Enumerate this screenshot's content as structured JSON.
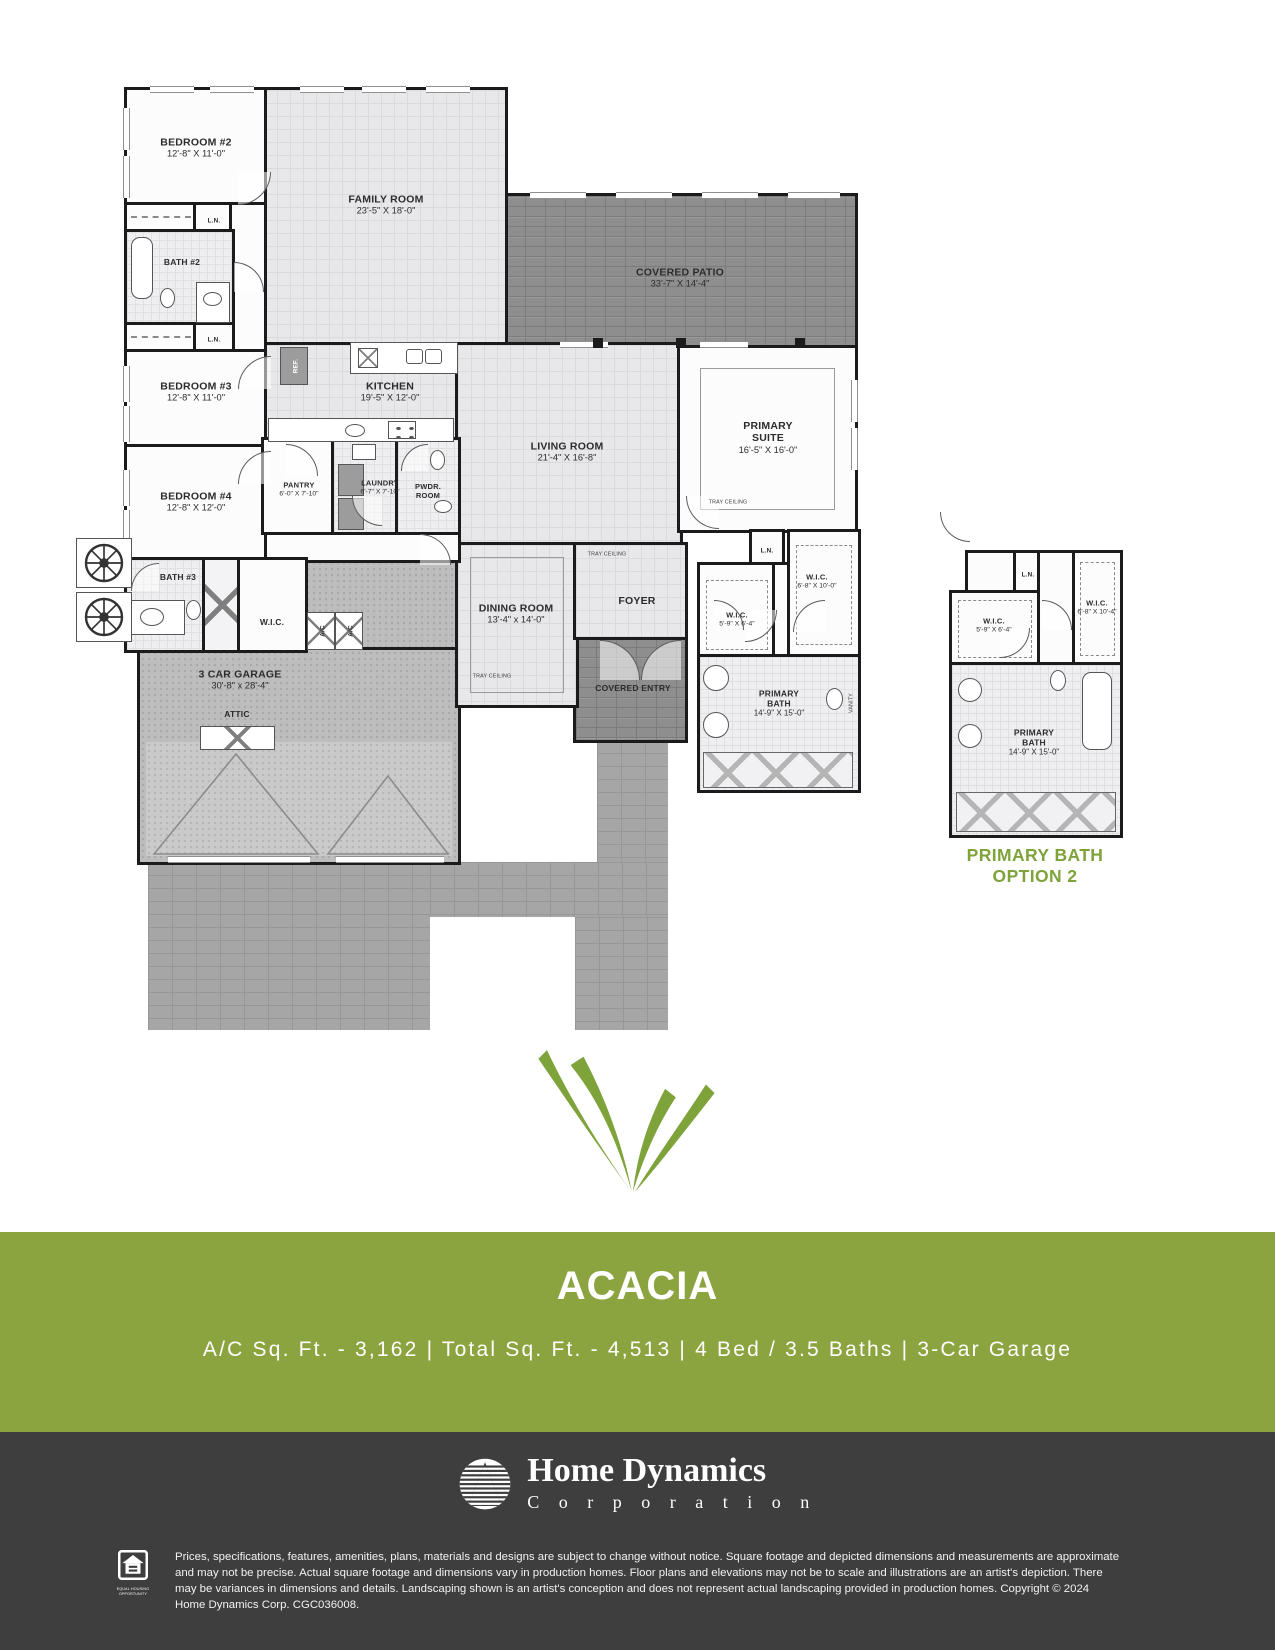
{
  "colors": {
    "green": "#8CA440",
    "dark": "#3E3E3E",
    "caption": "#7FA33B",
    "blade": "#7FA33B"
  },
  "plan": {
    "rooms": {
      "bedroom2": {
        "name": "BEDROOM #2",
        "dims": "12'-8\" X 11'-0\""
      },
      "bath2": {
        "name": "BATH #2"
      },
      "bedroom3": {
        "name": "BEDROOM #3",
        "dims": "12'-8\" X 11'-0\""
      },
      "bedroom4": {
        "name": "BEDROOM #4",
        "dims": "12'-8\" X 12'-0\""
      },
      "family": {
        "name": "FAMILY ROOM",
        "dims": "23'-5\" X 18'-0\""
      },
      "kitchen": {
        "name": "KITCHEN",
        "dims": "19'-5\" X 12'-0\""
      },
      "patio": {
        "name": "COVERED PATIO",
        "dims": "33'-7\" X 14'-4\""
      },
      "living": {
        "name": "LIVING ROOM",
        "dims": "21'-4\" X 16'-8\""
      },
      "primary_suite": {
        "name": "PRIMARY SUITE",
        "dims": "16'-5\" X 16'-0\""
      },
      "pantry": {
        "name": "PANTRY",
        "dims": "6'-0\" X 7'-10\""
      },
      "laundry": {
        "name": "LAUNDRY",
        "dims": "6'-7\" X 7'-10\""
      },
      "pwdr": {
        "name": "PWDR. ROOM"
      },
      "bath3": {
        "name": "BATH #3"
      },
      "wic_hall": {
        "name": "W.I.C."
      },
      "garage": {
        "name": "3 CAR GARAGE",
        "dims": "30'-8\" x 28'-4\""
      },
      "attic": {
        "name": "ATTIC"
      },
      "dining": {
        "name": "DINING ROOM",
        "dims": "13'-4\" x 14'-0\""
      },
      "foyer": {
        "name": "FOYER"
      },
      "entry": {
        "name": "COVERED ENTRY"
      },
      "wic_small": {
        "name": "W.I.C.",
        "dims": "5'-9\" X 6'-4\""
      },
      "wic_large": {
        "name": "W.I.C.",
        "dims": "6'-8\" X 10'-0\""
      },
      "primary_bath": {
        "name": "PRIMARY BATH",
        "dims": "14'-9\" X 15'-0\""
      }
    },
    "labels": {
      "ln": "L.N.",
      "ref": "REF.",
      "ac": "A/C",
      "vanity": "VANITY",
      "tray": "TRAY CEILING"
    },
    "option2": {
      "caption1": "PRIMARY BATH",
      "caption2": "OPTION 2",
      "wic_small": {
        "name": "W.I.C.",
        "dims": "5'-9\" X 6'-4\""
      },
      "wic_large": {
        "name": "W.I.C.",
        "dims": "6'-8\" X 10'-4\""
      },
      "bath": {
        "name": "PRIMARY BATH",
        "dims": "14'-9\" X 15'-0\""
      }
    }
  },
  "band": {
    "title": "ACACIA",
    "specs": "A/C Sq. Ft. - 3,162   |   Total Sq. Ft. - 4,513   |   4 Bed / 3.5 Baths   |   3-Car Garage"
  },
  "brand": {
    "name": "Home Dynamics",
    "sub": "C o r p o r a t i o n"
  },
  "legal": {
    "equal_housing": "EQUAL HOUSING\nOPPORTUNITY",
    "disclaimer": "Prices, specifications, features, amenities, plans, materials and designs are subject to change without notice. Square footage and depicted dimensions and measurements are approximate and may not be precise. Actual square footage and dimensions vary in production homes. Floor plans and elevations may not be to scale and illustrations are an artist's depiction.  There may be variances in dimensions and details. Landscaping shown is an artist's conception and does not represent actual landscaping provided in production homes. Copyright © 2024 Home Dynamics Corp. CGC036008."
  }
}
